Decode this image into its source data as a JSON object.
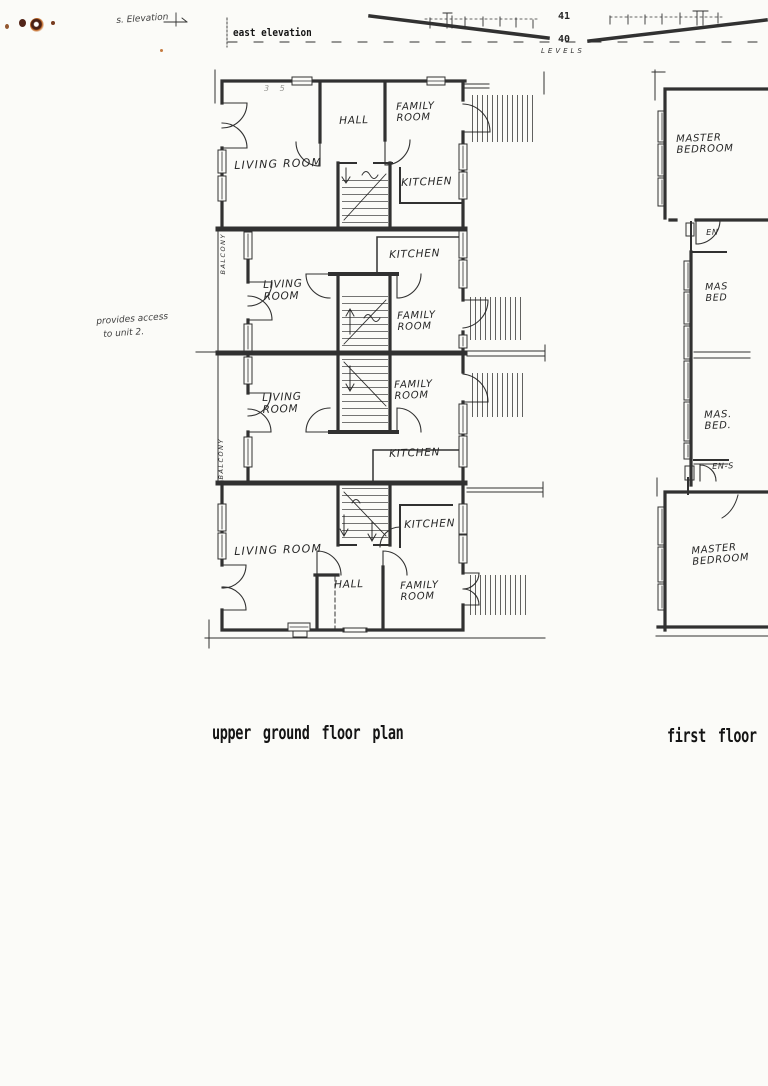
{
  "document": {
    "paper_color": "#fbfbf8",
    "ink_color": "#1c1c1c",
    "stain_color": "#b05a18"
  },
  "header": {
    "handwritten_label": "s. Elevation",
    "east_elevation_label": "east elevation",
    "levels": {
      "upper": "41",
      "lower": "40",
      "caption": "LEVELS"
    }
  },
  "margin_note": {
    "line1": "provides access",
    "line2": "to unit 2."
  },
  "pencil_mark": "3 5",
  "upper_plan": {
    "caption": "upper ground floor plan",
    "balcony_upper": "BALCONY",
    "balcony_lower": "BALCONY",
    "unit1": {
      "living": "LIVING ROOM",
      "hall": "HALL",
      "family": "FAMILY ROOM",
      "kitchen": "KITCHEN"
    },
    "unit2": {
      "living": "LIVING ROOM",
      "family": "FAMILY ROOM",
      "kitchen": "KITCHEN"
    },
    "unit3": {
      "living": "LIVING ROOM",
      "family": "FAMILY ROOM",
      "kitchen": "KITCHEN"
    },
    "unit4": {
      "living": "LIVING ROOM",
      "hall": "HALL",
      "family": "FAMILY ROOM",
      "kitchen": "KITCHEN"
    }
  },
  "first_floor": {
    "caption": "first floor",
    "master_top": "MASTER BEDROOM",
    "ensuite_top": "EN",
    "master_mid_upper": "MAS BED",
    "master_mid_lower": "MAS. BED.",
    "ensuite_mid": "EN-S",
    "master_bottom": "MASTER BEDROOM"
  }
}
